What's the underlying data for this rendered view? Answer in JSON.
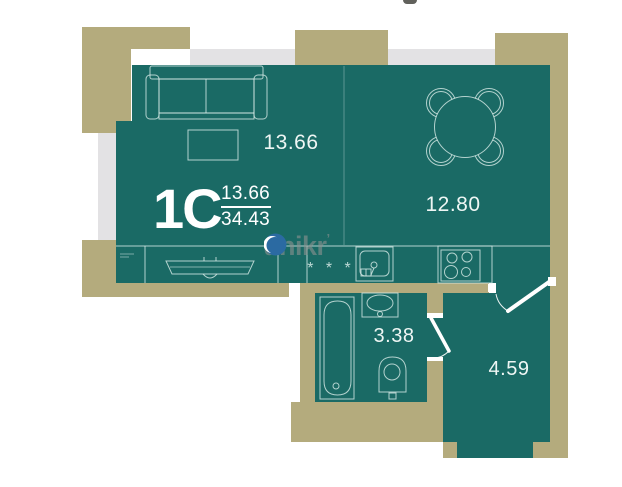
{
  "plan": {
    "type_label": "1C",
    "area_ratio": {
      "numerator": "13.66",
      "denominator": "34.43"
    },
    "rooms": {
      "living": {
        "area": "13.66"
      },
      "kitchen": {
        "area": "12.80"
      },
      "bathroom": {
        "area": "3.38"
      },
      "hallway": {
        "area": "4.59"
      }
    },
    "counter_marks": "* * *"
  },
  "watermark": {
    "prefix": "unik",
    "suffix": "r",
    "tick": "’"
  },
  "colors": {
    "floor_teal": "#1a6a65",
    "wall_khaki": "#b4ab7d",
    "backdrop_gray": "#e3e2e4",
    "outline_light": "#d9ece9",
    "label_text": "#eef6f4",
    "type_text": "#ffffff",
    "watermark_gray": "#8b918f",
    "watermark_blue": "#2b6aa2",
    "door_white": "#ffffff"
  }
}
